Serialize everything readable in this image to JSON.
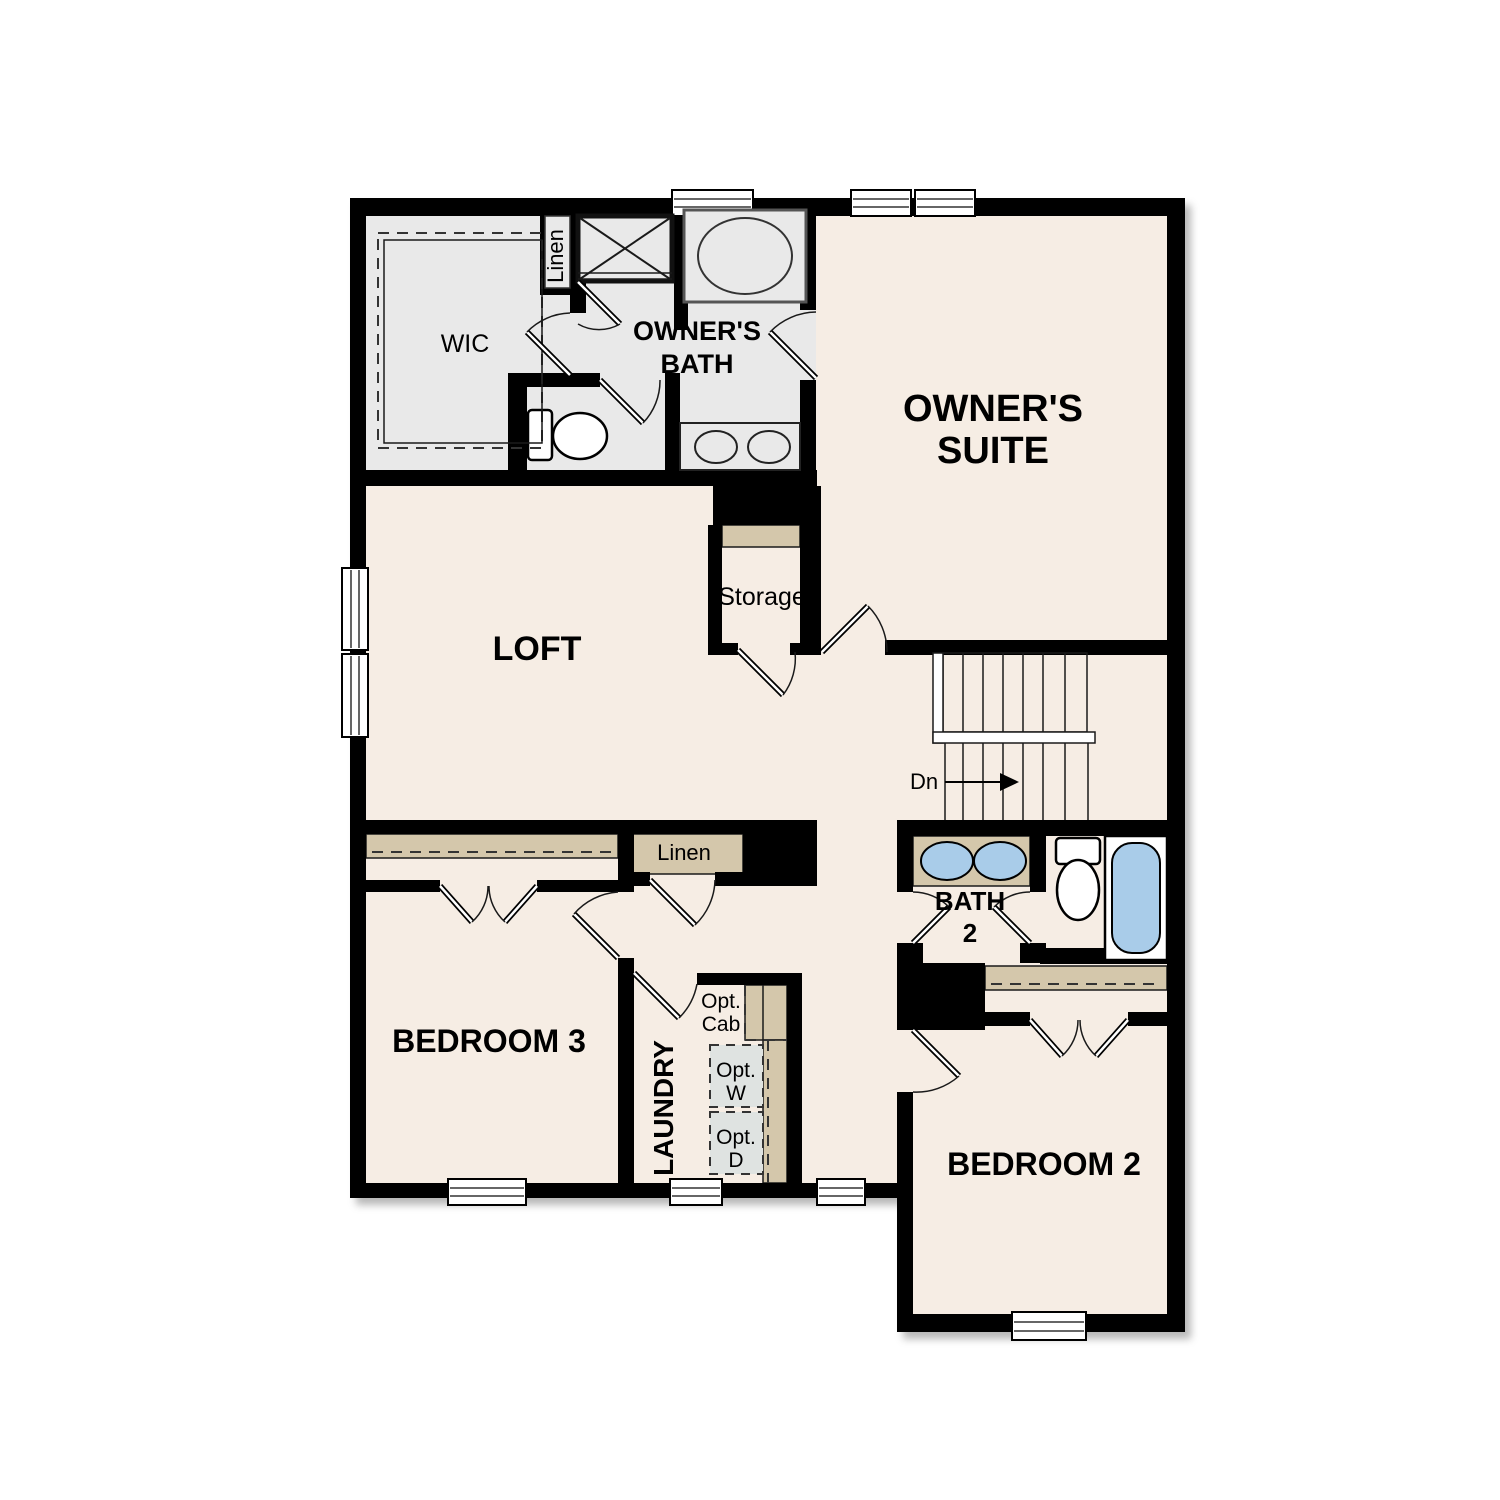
{
  "title": "Second floor plan",
  "colors": {
    "wall": "#000000",
    "floor_cream": "#f6ede4",
    "bath_gray": "#e9e9e9",
    "shelf_tan": "#d4c7ab",
    "fixture_blue": "#a9cce9",
    "opt_gray": "#dfe3e1"
  },
  "rooms": {
    "owners_suite": {
      "label_line1": "OWNER'S",
      "label_line2": "SUITE"
    },
    "owners_bath": {
      "label_line1": "OWNER'S",
      "label_line2": "BATH"
    },
    "wic": {
      "label": "WIC"
    },
    "linen_upper": {
      "label": "Linen"
    },
    "loft": {
      "label": "LOFT"
    },
    "storage": {
      "label": "Storage"
    },
    "linen_lower": {
      "label": "Linen"
    },
    "bedroom3": {
      "label": "BEDROOM 3"
    },
    "laundry": {
      "label": "LAUNDRY"
    },
    "bath2": {
      "label_line1": "BATH",
      "label_line2": "2"
    },
    "bedroom2": {
      "label": "BEDROOM 2"
    }
  },
  "stairs": {
    "direction_label": "Dn"
  },
  "options": {
    "cabinet": {
      "line1": "Opt.",
      "line2": "Cab"
    },
    "washer": {
      "line1": "Opt.",
      "line2": "W"
    },
    "dryer": {
      "line1": "Opt.",
      "line2": "D"
    }
  }
}
